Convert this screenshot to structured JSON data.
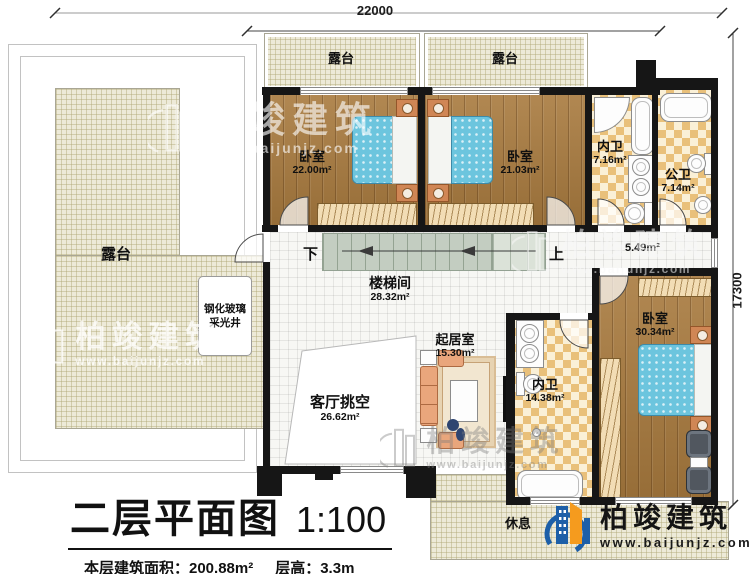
{
  "title_block": {
    "title": "二层平面图",
    "scale": "1:100",
    "area_info": "本层建筑面积：200.88m²",
    "height_info": "层高：3.3m"
  },
  "dimensions": {
    "top": "22000",
    "right": "17300"
  },
  "rooms": {
    "terrace_left": {
      "name": "露台"
    },
    "terrace_top_left": {
      "name": "露台"
    },
    "terrace_top_right": {
      "name": "露台"
    },
    "bedroom_left": {
      "name": "卧室",
      "area": "22.00m²"
    },
    "bedroom_mid": {
      "name": "卧室",
      "area": "21.03m²"
    },
    "bath_master1": {
      "name": "内卫",
      "area": "7.16m²"
    },
    "bath_public": {
      "name": "公卫",
      "area": "7.14m²"
    },
    "hallway": {
      "area": "5.49m²"
    },
    "stairwell": {
      "name": "楼梯间",
      "area": "28.32m²"
    },
    "living": {
      "name": "起居室",
      "area": "15.30m²"
    },
    "bath_master2": {
      "name": "内卫",
      "area": "14.38m²"
    },
    "bedroom_right": {
      "name": "卧室",
      "area": "30.34m²"
    },
    "void": {
      "name": "客厅挑空",
      "area": "26.62m²"
    },
    "lightwell": {
      "line1": "钢化玻璃",
      "line2": "采光井"
    },
    "rest": {
      "name": "休息"
    }
  },
  "stairs": {
    "down": "下",
    "up": "上"
  },
  "brand": {
    "name": "柏竣建筑",
    "url": "www.baijunjz.com",
    "blue": "#1d5fa8",
    "orange": "#f59b1e"
  },
  "watermark": {
    "name": "柏竣建筑",
    "url": "www.baijunjz.com"
  }
}
